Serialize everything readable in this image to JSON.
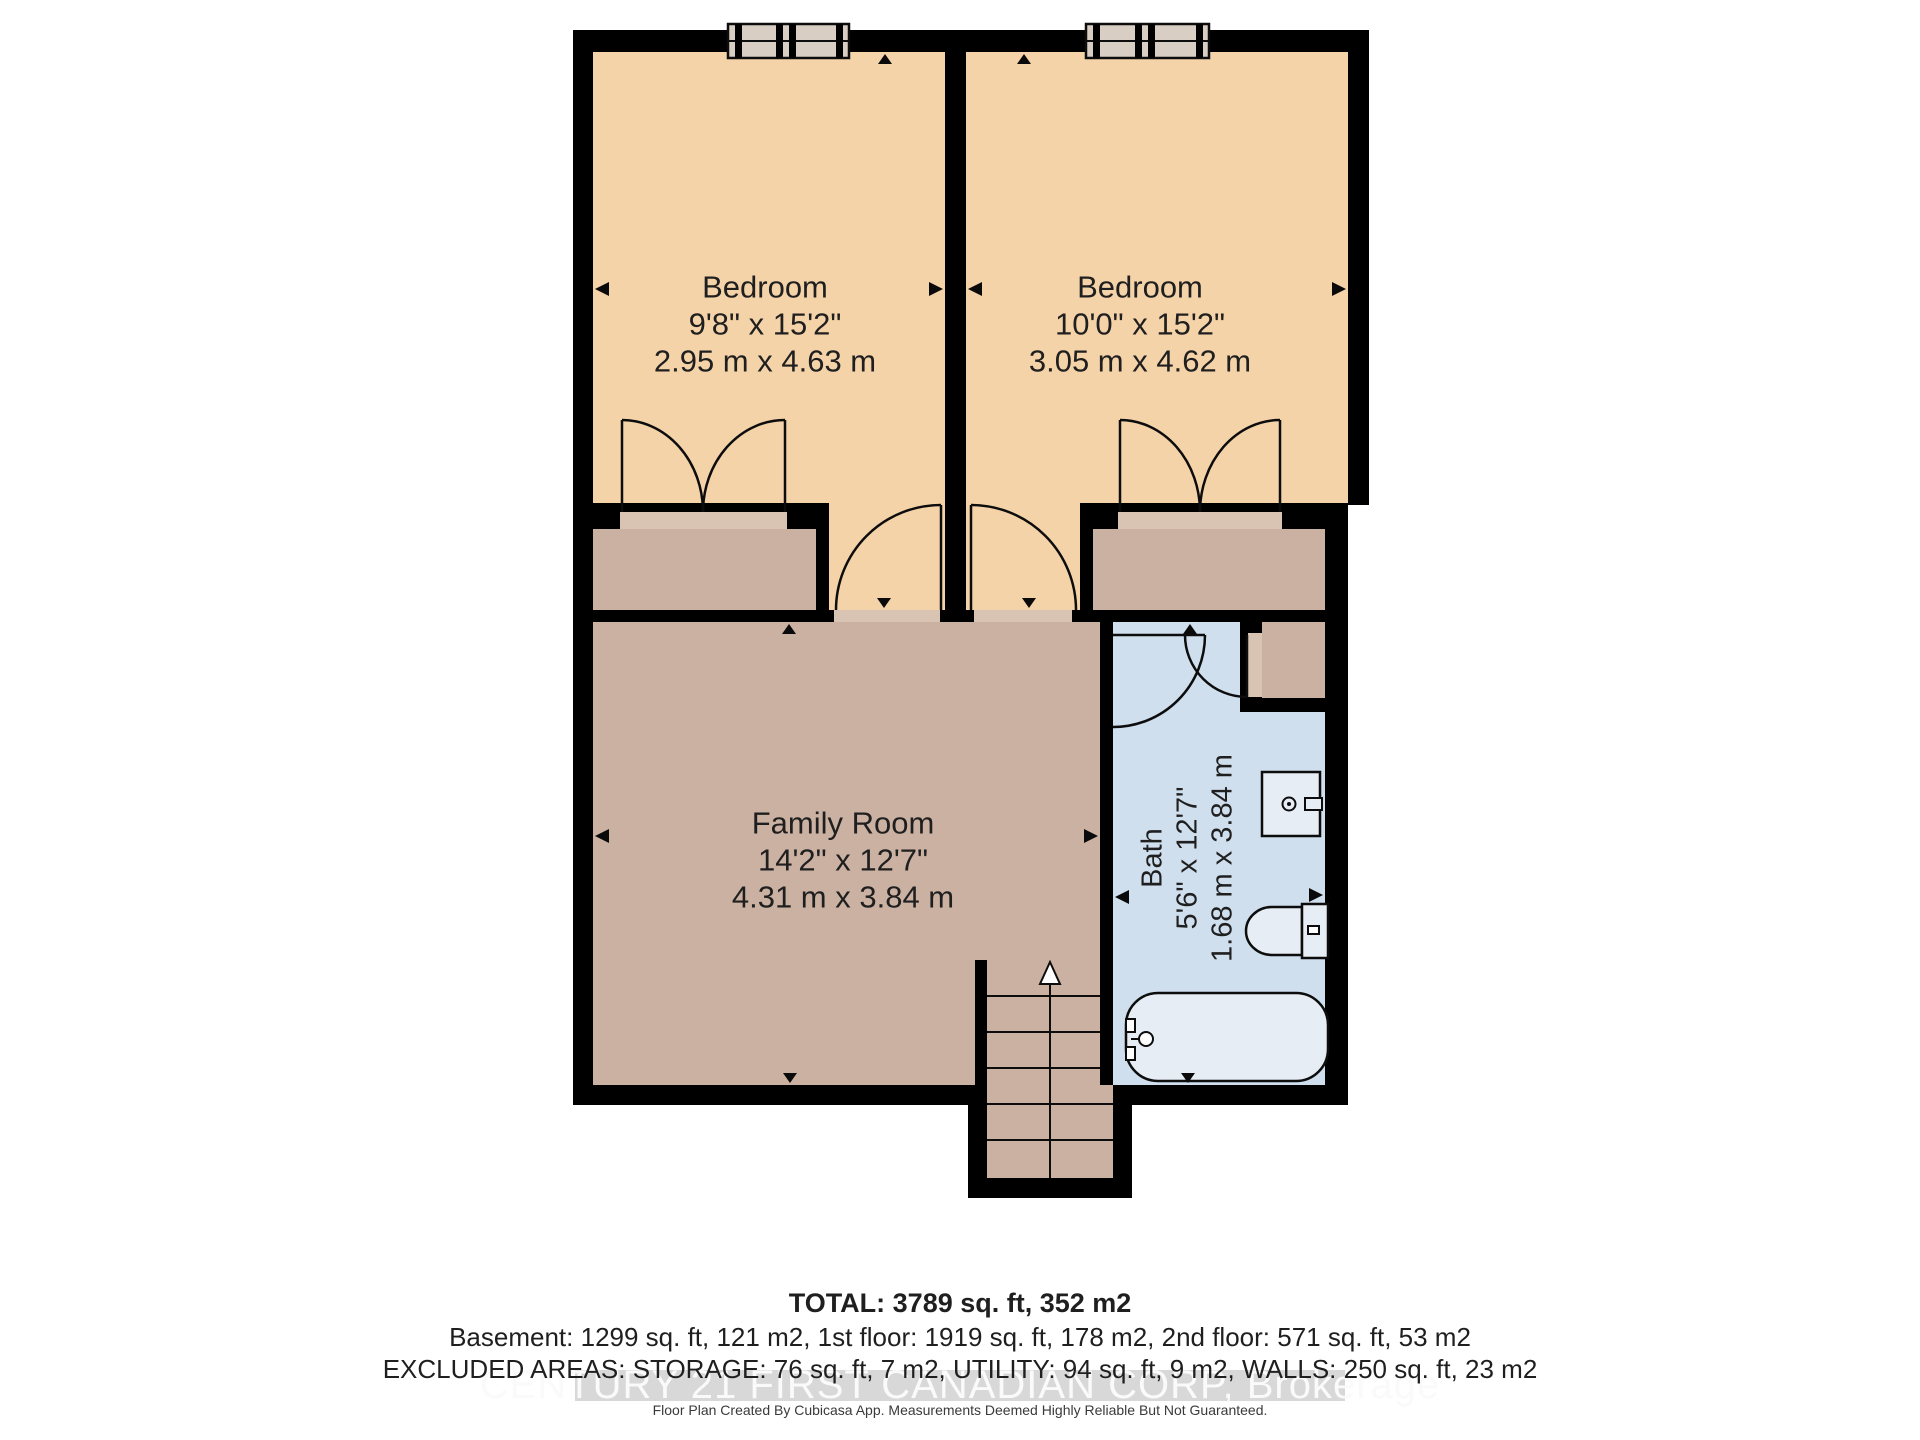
{
  "colors": {
    "wall": "#000000",
    "bedroom_floor": "#f5d3a9",
    "living_floor": "#cbb1a2",
    "sill": "#d9c4b3",
    "bath_floor": "#d0dfee",
    "window_fill": "#d9cec3",
    "fixture_fill": "#e7edf4",
    "watermark_band": "#d8d8d8",
    "watermark_text": "#fafafa",
    "text": "#1f1f1f"
  },
  "floorplan": {
    "rooms": [
      {
        "name": "Bedroom",
        "dims_imperial": "9'8\" x 15'2\"",
        "dims_metric": "2.95 m x 4.63 m"
      },
      {
        "name": "Bedroom",
        "dims_imperial": "10'0\" x 15'2\"",
        "dims_metric": "3.05 m x 4.62 m"
      },
      {
        "name": "Family Room",
        "dims_imperial": "14'2\" x 12'7\"",
        "dims_metric": "4.31 m x 3.84 m"
      },
      {
        "name": "Bath",
        "dims_imperial": "5'6\" x 12'7\"",
        "dims_metric": "1.68 m x 3.84 m"
      }
    ]
  },
  "footer": {
    "total": "TOTAL: 3789 sq. ft, 352 m2",
    "floors": "Basement: 1299 sq. ft, 121 m2, 1st floor: 1919 sq. ft, 178 m2, 2nd floor: 571 sq. ft, 53 m2",
    "excluded": "EXCLUDED AREAS: STORAGE: 76 sq. ft, 7 m2, UTILITY: 94 sq. ft, 9 m2, WALLS: 250 sq. ft, 23 m2",
    "watermark": "CENTURY 21 FIRST CANADIAN CORP, Brokerage",
    "disclaimer": "Floor Plan Created By Cubicasa App. Measurements Deemed Highly Reliable But Not Guaranteed."
  }
}
